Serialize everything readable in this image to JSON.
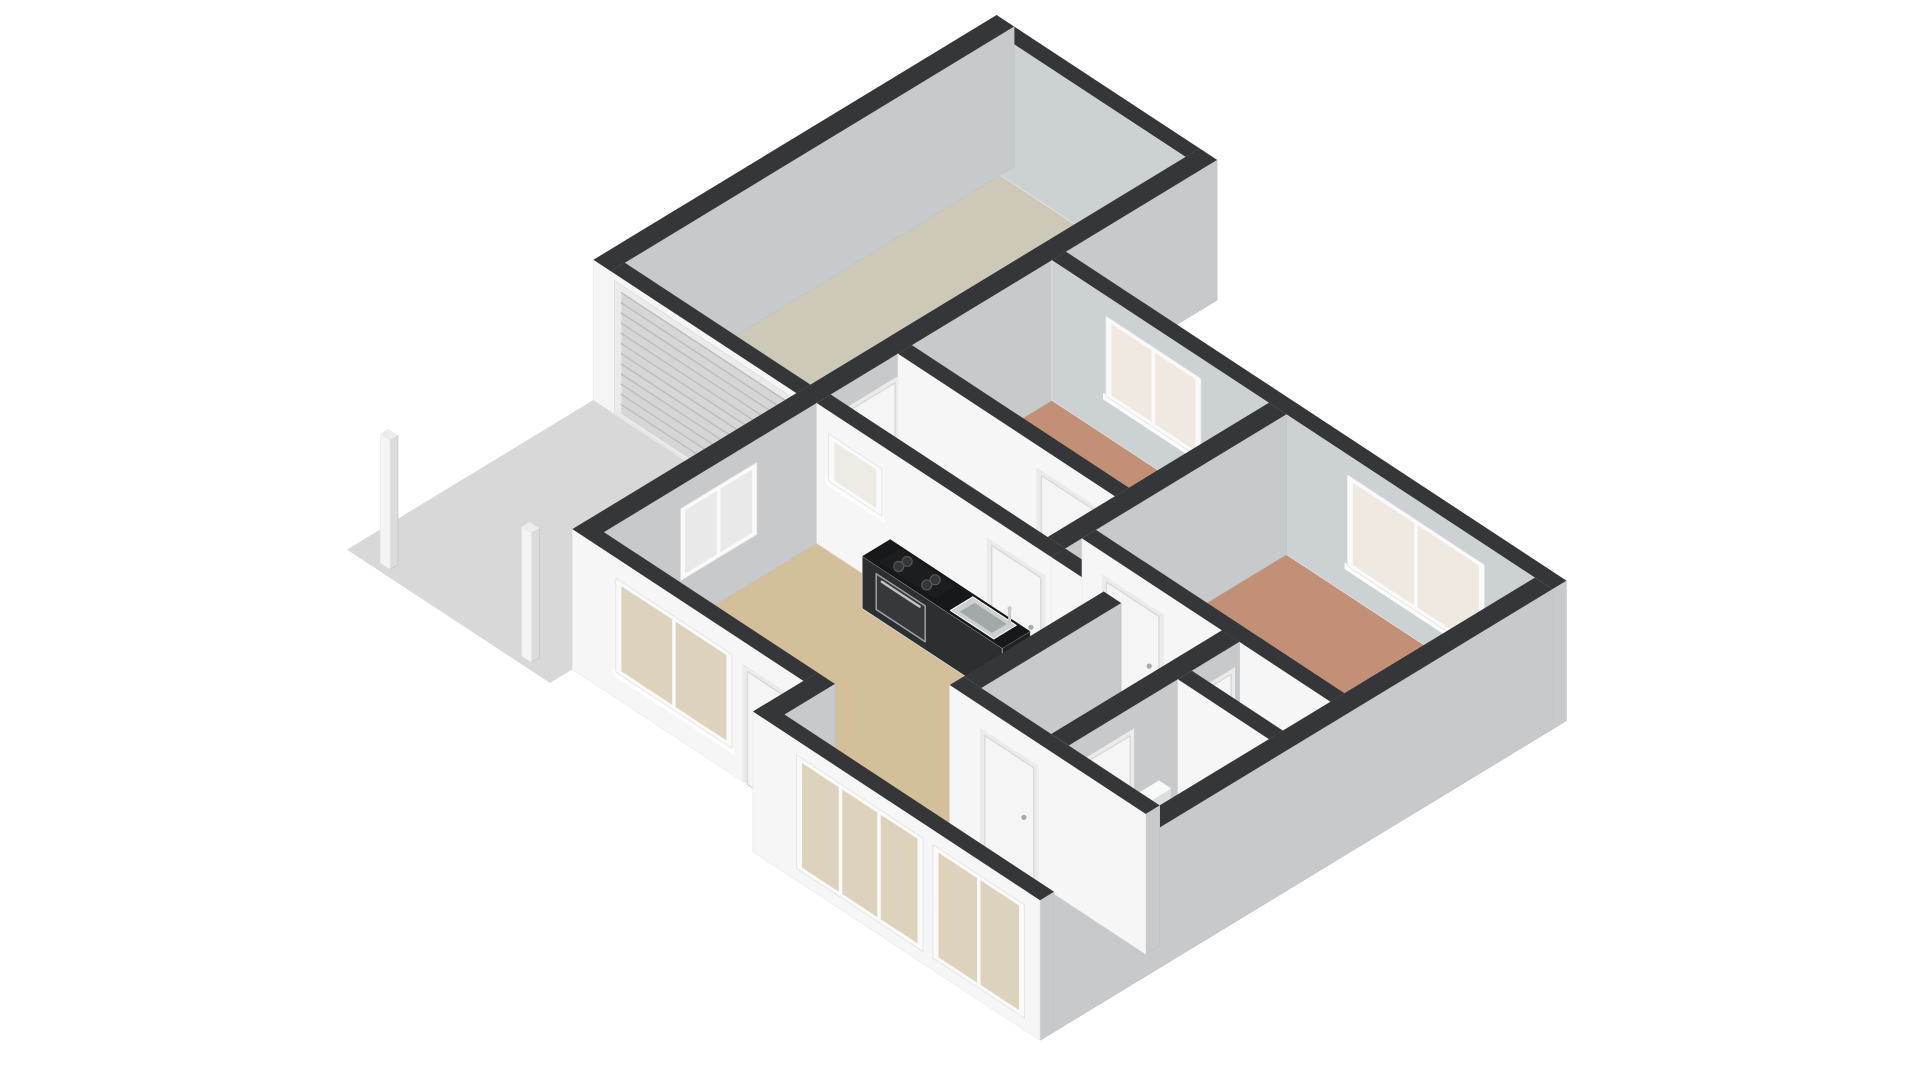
{
  "meta": {
    "view": "3d-floorplan-dollhouse-render",
    "background": "#ffffff"
  },
  "projection": {
    "origin": [
      522,
      700
    ],
    "e": [
      70,
      46
    ],
    "n": [
      56,
      -34
    ],
    "h": -55,
    "wall_height": 2.55
  },
  "palette": {
    "background": "#ffffff",
    "wall_top": "#343639",
    "wall_front": "#f6f6f6",
    "wall_front_stroke": "#e9e9e9",
    "wall_side": "#c6cacc",
    "wall_side_stroke": "#bdc1c3",
    "door": "#f5f5f5",
    "door_frame": "#d9d9d9",
    "window_frame": "#fafafa",
    "driveway": "#d8d8d8",
    "roller_door": "#d6d6d6",
    "roller_slat": "#bcbcbc",
    "counter_top": "#161819",
    "glass_front": "#ddd2bc",
    "glass_pale": "#f0e9e2"
  },
  "ground": {
    "driveway": {
      "id": "driveway-slab",
      "color": "#d8d8d8",
      "poly": [
        [
          -2.9,
          0.5
        ],
        [
          0,
          0.5
        ],
        [
          0,
          4.9
        ],
        [
          -2.9,
          4.9
        ]
      ]
    }
  },
  "rooms": [
    {
      "id": "living-room",
      "color": "#d3bf9a",
      "poly": [
        [
          0.25,
          1.15
        ],
        [
          3.55,
          1.15
        ],
        [
          3.55,
          0.25
        ],
        [
          7.15,
          0.25
        ],
        [
          7.15,
          2.2
        ],
        [
          4.35,
          2.2
        ],
        [
          4.35,
          4.95
        ],
        [
          0.25,
          4.95
        ]
      ]
    },
    {
      "id": "hallway-north",
      "color": "#b9bdbd",
      "poly": [
        [
          0.25,
          5.2
        ],
        [
          3.35,
          5.2
        ],
        [
          3.35,
          6.4
        ],
        [
          0.25,
          6.4
        ]
      ]
    },
    {
      "id": "bedroom-1",
      "color": "#c28f77",
      "poly": [
        [
          0.25,
          6.65
        ],
        [
          3.35,
          6.65
        ],
        [
          3.35,
          9.15
        ],
        [
          0.25,
          9.15
        ]
      ]
    },
    {
      "id": "bedroom-2",
      "color": "#c28f77",
      "poly": [
        [
          3.6,
          5.75
        ],
        [
          7.15,
          5.75
        ],
        [
          7.15,
          9.15
        ],
        [
          3.6,
          9.15
        ]
      ]
    },
    {
      "id": "hall-center",
      "color": "#e1a750",
      "poly": [
        [
          4.6,
          2.45
        ],
        [
          5.6,
          2.45
        ],
        [
          5.6,
          5.5
        ],
        [
          3.6,
          5.5
        ],
        [
          3.6,
          5.2
        ],
        [
          4.6,
          5.2
        ]
      ]
    },
    {
      "id": "closet",
      "color": "#e1a750",
      "poly": [
        [
          5.85,
          4.65
        ],
        [
          7.15,
          4.65
        ],
        [
          7.15,
          5.5
        ],
        [
          5.85,
          5.5
        ]
      ]
    },
    {
      "id": "bathroom",
      "color": "#a9c1d9",
      "poly": [
        [
          5.85,
          2.45
        ],
        [
          7.15,
          2.45
        ],
        [
          7.15,
          4.4
        ],
        [
          5.85,
          4.4
        ]
      ]
    },
    {
      "id": "garage",
      "color": "#cdc8b7",
      "poly": [
        [
          -2.65,
          5.15
        ],
        [
          0,
          5.15
        ],
        [
          0,
          11.85
        ],
        [
          -2.65,
          11.85
        ]
      ]
    }
  ],
  "walls": [
    {
      "id": "wall-front-recessed",
      "e": [
        0,
        3.3
      ],
      "n": [
        0.9,
        1.15
      ]
    },
    {
      "id": "wall-entry-return",
      "e": [
        3.3,
        3.55
      ],
      "n": [
        0,
        1.15
      ]
    },
    {
      "id": "wall-front-main",
      "e": [
        3.3,
        7.4
      ],
      "n": [
        0,
        0.25
      ]
    },
    {
      "id": "wall-west",
      "e": [
        0,
        0.25
      ],
      "n": [
        0.9,
        12.1
      ]
    },
    {
      "id": "wall-north",
      "e": [
        0.25,
        7.4
      ],
      "n": [
        9.15,
        9.4
      ],
      "colors": {
        "s": "#ccd1d4"
      }
    },
    {
      "id": "wall-east",
      "e": [
        7.15,
        7.4
      ],
      "n": [
        0.25,
        9.15
      ]
    },
    {
      "id": "wall-garage-west",
      "e": [
        -2.9,
        -2.65
      ],
      "n": [
        4.9,
        12.1
      ]
    },
    {
      "id": "wall-garage-north",
      "e": [
        -2.65,
        0
      ],
      "n": [
        11.85,
        12.1
      ],
      "colors": {
        "s": "#ccd1d4"
      }
    },
    {
      "id": "wall-garage-south",
      "e": [
        -2.65,
        0
      ],
      "n": [
        4.9,
        5.15
      ]
    },
    {
      "id": "wall-kitchen",
      "e": [
        0.25,
        3.6
      ],
      "n": [
        4.95,
        5.2
      ]
    },
    {
      "id": "wall-kitchen-east",
      "e": [
        3.6,
        4.6
      ],
      "n": [
        4.95,
        5.2
      ]
    },
    {
      "id": "wall-mid",
      "e": [
        3.35,
        3.6
      ],
      "n": [
        5.2,
        9.15
      ]
    },
    {
      "id": "wall-bedroom1-south",
      "e": [
        0.25,
        3.35
      ],
      "n": [
        6.4,
        6.65
      ]
    },
    {
      "id": "wall-living-east",
      "e": [
        4.35,
        4.6
      ],
      "n": [
        2.45,
        4.95
      ]
    },
    {
      "id": "wall-hall-south",
      "e": [
        4.35,
        7.15
      ],
      "n": [
        2.2,
        2.45
      ]
    },
    {
      "id": "wall-bath-west",
      "e": [
        5.6,
        5.85
      ],
      "n": [
        2.45,
        5.5
      ]
    },
    {
      "id": "wall-bath-north",
      "e": [
        5.85,
        7.15
      ],
      "n": [
        4.4,
        4.65
      ]
    },
    {
      "id": "wall-bedroom2-south",
      "e": [
        3.6,
        7.15
      ],
      "n": [
        5.5,
        5.75
      ]
    }
  ],
  "openings": [
    {
      "wall": "wall-front-recessed",
      "type": "window",
      "face": "S",
      "span": [
        0.7,
        2.2
      ],
      "sill": 0.55,
      "head": 2.1,
      "panes": 2,
      "glass": "#ddd2bc"
    },
    {
      "wall": "wall-front-recessed",
      "type": "door",
      "face": "S",
      "span": [
        2.5,
        3.1
      ]
    },
    {
      "wall": "wall-front-main",
      "type": "window",
      "face": "S",
      "span": [
        4.0,
        5.65
      ],
      "sill": 0.3,
      "head": 2.2,
      "panes": 3,
      "glass": "#ddd2bc"
    },
    {
      "wall": "wall-front-main",
      "type": "window",
      "face": "S",
      "span": [
        5.95,
        7.1
      ],
      "sill": 0.3,
      "head": 2.2,
      "panes": 2,
      "glass": "#ddd2bc"
    },
    {
      "wall": "wall-west",
      "type": "window",
      "face": "E",
      "span": [
        2.6,
        3.8
      ],
      "sill": 0.9,
      "head": 2.05,
      "panes": 2,
      "glass": "#e9e9e9"
    },
    {
      "wall": "wall-west",
      "type": "door",
      "face": "E",
      "span": [
        5.55,
        6.35
      ]
    },
    {
      "wall": "wall-north",
      "type": "window",
      "face": "S",
      "span": [
        1.1,
        2.3
      ],
      "sill": 0.8,
      "head": 2.1,
      "panes": 2,
      "glass": "#f0e9e2"
    },
    {
      "wall": "wall-north",
      "type": "window",
      "face": "S",
      "span": [
        4.55,
        6.35
      ],
      "sill": 0.6,
      "head": 2.1,
      "panes": 2,
      "glass": "#f0e9e2"
    },
    {
      "wall": "wall-garage-south",
      "type": "roller",
      "face": "S",
      "span": [
        -2.5,
        -0.15
      ],
      "h": [
        0.08,
        2.3
      ]
    },
    {
      "wall": "wall-kitchen",
      "type": "window",
      "face": "S",
      "span": [
        0.5,
        1.1
      ],
      "sill": 1.35,
      "head": 2.05,
      "panes": 1,
      "glass": "#eeeae4"
    },
    {
      "wall": "wall-kitchen",
      "type": "door",
      "face": "S",
      "span": [
        2.75,
        3.45
      ]
    },
    {
      "wall": "wall-bedroom1-south",
      "type": "door",
      "face": "S",
      "span": [
        2.3,
        3.05
      ]
    },
    {
      "wall": "wall-hall-south",
      "type": "door",
      "face": "S",
      "span": [
        4.85,
        5.55
      ]
    },
    {
      "wall": "wall-bath-west",
      "type": "door",
      "face": "E",
      "span": [
        2.85,
        3.55
      ]
    },
    {
      "wall": "wall-bath-west",
      "type": "door",
      "face": "E",
      "span": [
        4.75,
        5.35
      ]
    },
    {
      "wall": "wall-bedroom2-south",
      "type": "door",
      "face": "S",
      "span": [
        3.95,
        4.7
      ]
    }
  ],
  "furniture": {
    "boxes": [
      {
        "id": "kitchen-counter",
        "e": [
          1.3,
          3.3
        ],
        "n": [
          4.45,
          4.95
        ],
        "h": 0.95,
        "colors": {
          "top": "#161819",
          "s": "#2c2f30",
          "e": "#202324"
        }
      },
      {
        "id": "toilet-tank",
        "e": [
          5.9,
          6.08
        ],
        "n": [
          3.5,
          4.0
        ],
        "h": 1.0,
        "colors": {
          "s": "#eef0f0",
          "e": "#dadedf",
          "top": "#f8f9f9"
        }
      },
      {
        "id": "toilet-bowl",
        "e": [
          6.08,
          6.48
        ],
        "n": [
          3.57,
          3.94
        ],
        "h": 0.42,
        "colors": {
          "s": "#f1f3f3",
          "e": "#e0e3e4",
          "top": "#fafbfb"
        }
      },
      {
        "id": "bath-sink",
        "e": [
          5.9,
          6.18
        ],
        "n": [
          2.78,
          3.16
        ],
        "h": 0.85,
        "colors": {
          "s": "#f1f3f3",
          "e": "#dfe2e3",
          "top": "#f9fafa"
        }
      },
      {
        "id": "carport-post-1",
        "e": [
          -0.5,
          -0.36
        ],
        "n": [
          0.62,
          0.76
        ],
        "h": 2.35,
        "colors": {
          "s": "#f4f4f4",
          "e": "#dcdcdc",
          "top": "#ececec"
        }
      },
      {
        "id": "carport-post-2",
        "e": [
          -2.52,
          -2.38
        ],
        "n": [
          0.62,
          0.76
        ],
        "h": 2.35,
        "colors": {
          "s": "#f4f4f4",
          "e": "#dcdcdc",
          "top": "#ececec"
        }
      }
    ],
    "kitchen": {
      "surface_h": 0.955,
      "cooktop": {
        "e": [
          1.48,
          2.28
        ],
        "n": [
          4.52,
          4.9
        ],
        "color": "#1b1d1e",
        "burners": [
          [
            1.67,
            4.64
          ],
          [
            1.67,
            4.79
          ],
          [
            2.07,
            4.64
          ],
          [
            2.07,
            4.79
          ]
        ],
        "burner_color": "#33373a",
        "burner_ring": "#53585c"
      },
      "sink": {
        "outer": [
          2.52,
          3.14,
          4.5,
          4.9
        ],
        "inner": [
          2.6,
          3.06,
          4.57,
          4.83
        ],
        "outer_color": "#ccd0d1",
        "inner_color": "#a2a9ab",
        "faucet": [
          3.07,
          4.87
        ],
        "faucet_color": "#c6cbcc"
      },
      "oven": {
        "span": [
          1.5,
          2.2
        ],
        "h": [
          0.15,
          0.8
        ],
        "face_n": 4.45,
        "color": "#35393b",
        "frame": "#9ba1a4",
        "handle_h": 0.72,
        "handle_color": "#c0c5c7"
      }
    },
    "toilet_seat": {
      "center": [
        6.28,
        3.76,
        0.43
      ],
      "rx": 11,
      "ry": 7,
      "fill": "#ffffff",
      "stroke": "#d3d6d7"
    },
    "bath_faucet": {
      "at": [
        6.04,
        3.14
      ],
      "base_h": 0.86,
      "top_h": 1.1,
      "color": "#c6cbcc"
    }
  }
}
